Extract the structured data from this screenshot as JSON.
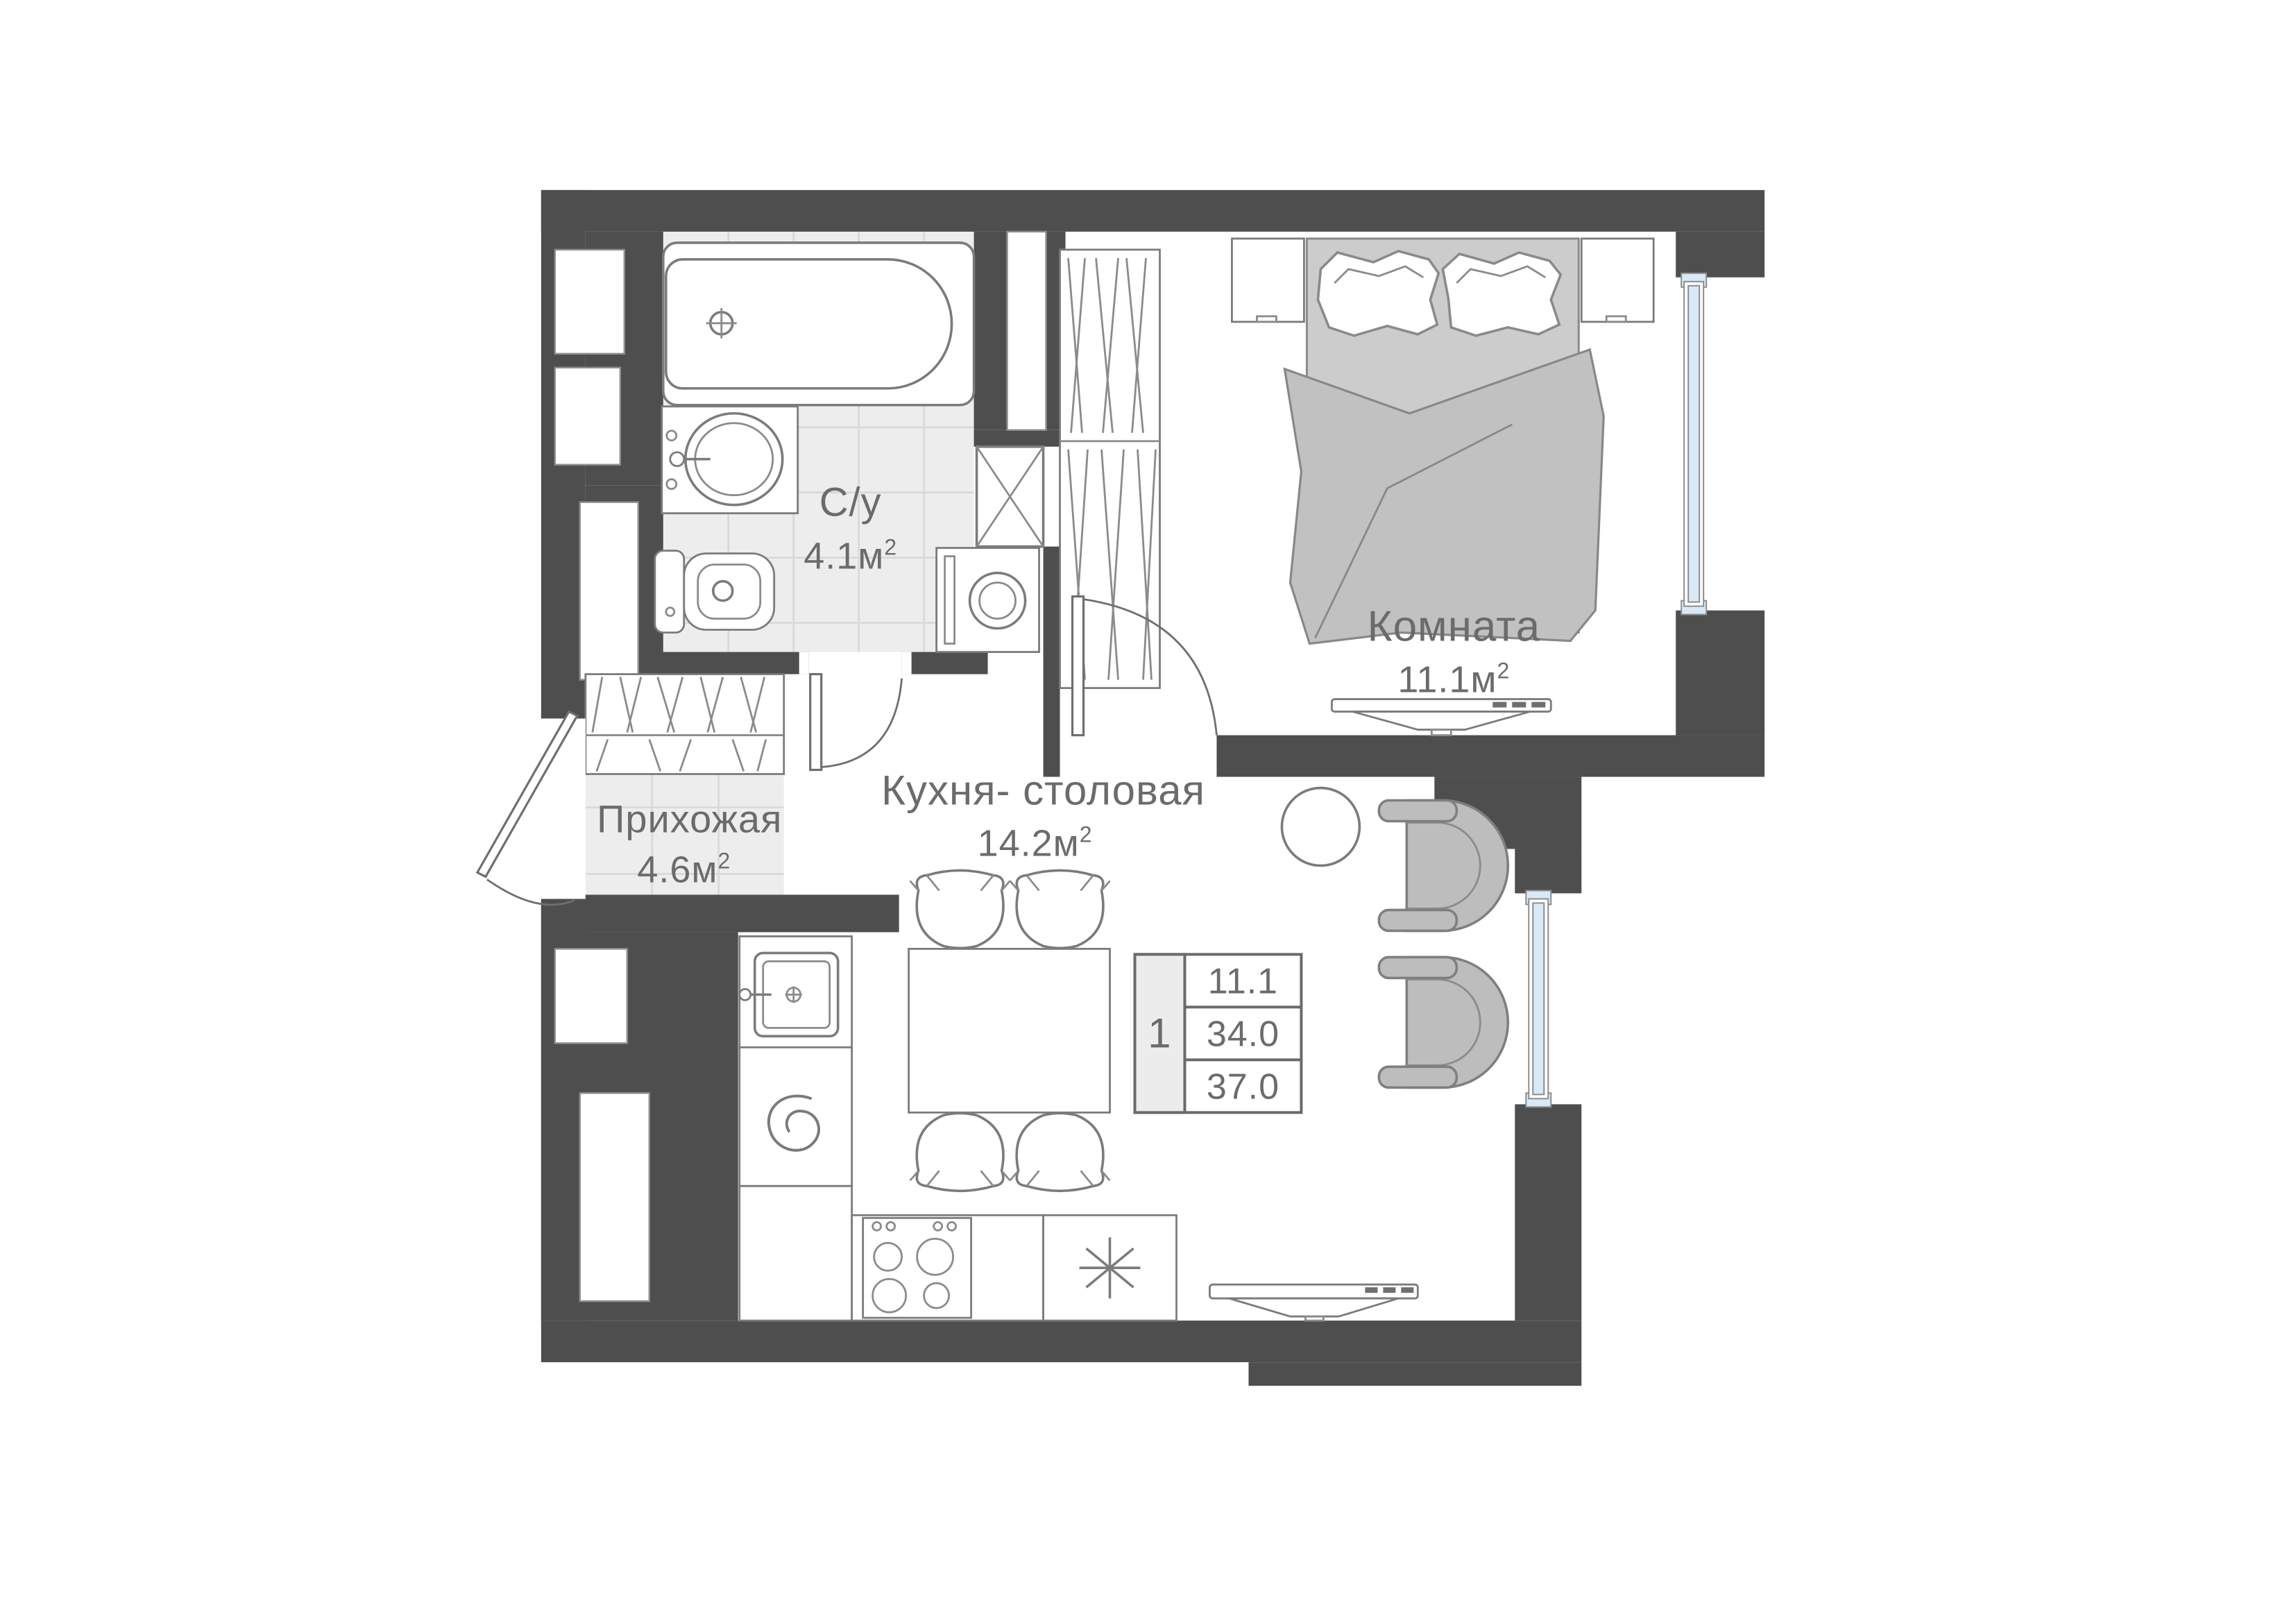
{
  "rooms": {
    "bathroom": {
      "name": "С/у",
      "area": "4.1",
      "unit": "м",
      "sup": "2"
    },
    "hallway": {
      "name": "Прихожая",
      "area": "4.6",
      "unit": "м",
      "sup": "2"
    },
    "bedroom": {
      "name": "Комната",
      "area": "11.1",
      "unit": "м",
      "sup": "2"
    },
    "kitchen": {
      "name": "Кухня- столовая",
      "area": "14.2",
      "unit": "м",
      "sup": "2"
    }
  },
  "info_table": {
    "rooms_count": "1",
    "rows": [
      "11.1",
      "34.0",
      "37.0"
    ]
  },
  "colors": {
    "wall": "#4e4e4e",
    "floor_tile": "#ededed",
    "tile_line": "#d9d9d9",
    "furniture_outline": "#7b7b7b",
    "soft_furniture": "#bdbdbd",
    "window_glass": "#d8eaf7",
    "label_text": "#6b6b6b"
  }
}
